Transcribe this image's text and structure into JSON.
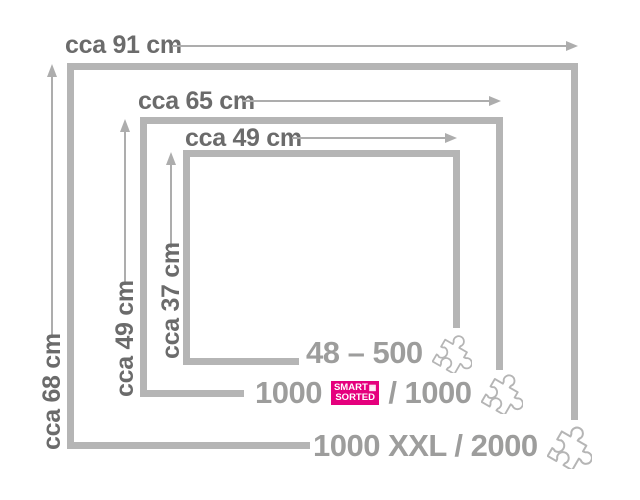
{
  "dimensions": {
    "outer_width": "cca 91 cm",
    "middle_width": "cca 65 cm",
    "inner_width": "cca 49 cm",
    "outer_height": "cca 68 cm",
    "middle_height": "cca 49 cm",
    "inner_height": "cca 37 cm"
  },
  "size_rows": [
    {
      "label": "48 – 500"
    },
    {
      "prefix": "1000",
      "badge": {
        "line1": "SMART",
        "line2": "SORTED"
      },
      "suffix": "/ 1000"
    },
    {
      "label": "1000 XXL / 2000"
    }
  ],
  "icons": {
    "puzzle_piece": "puzzle-piece-outline",
    "badge_grid": "▦"
  },
  "colors": {
    "box-border": "#b5b5b5",
    "arrow": "#adadad",
    "dim-text": "#6b6b6b",
    "big-text": "#9d9d9c",
    "badge-bg": "#e5007d",
    "badge-text": "#ffffff"
  }
}
